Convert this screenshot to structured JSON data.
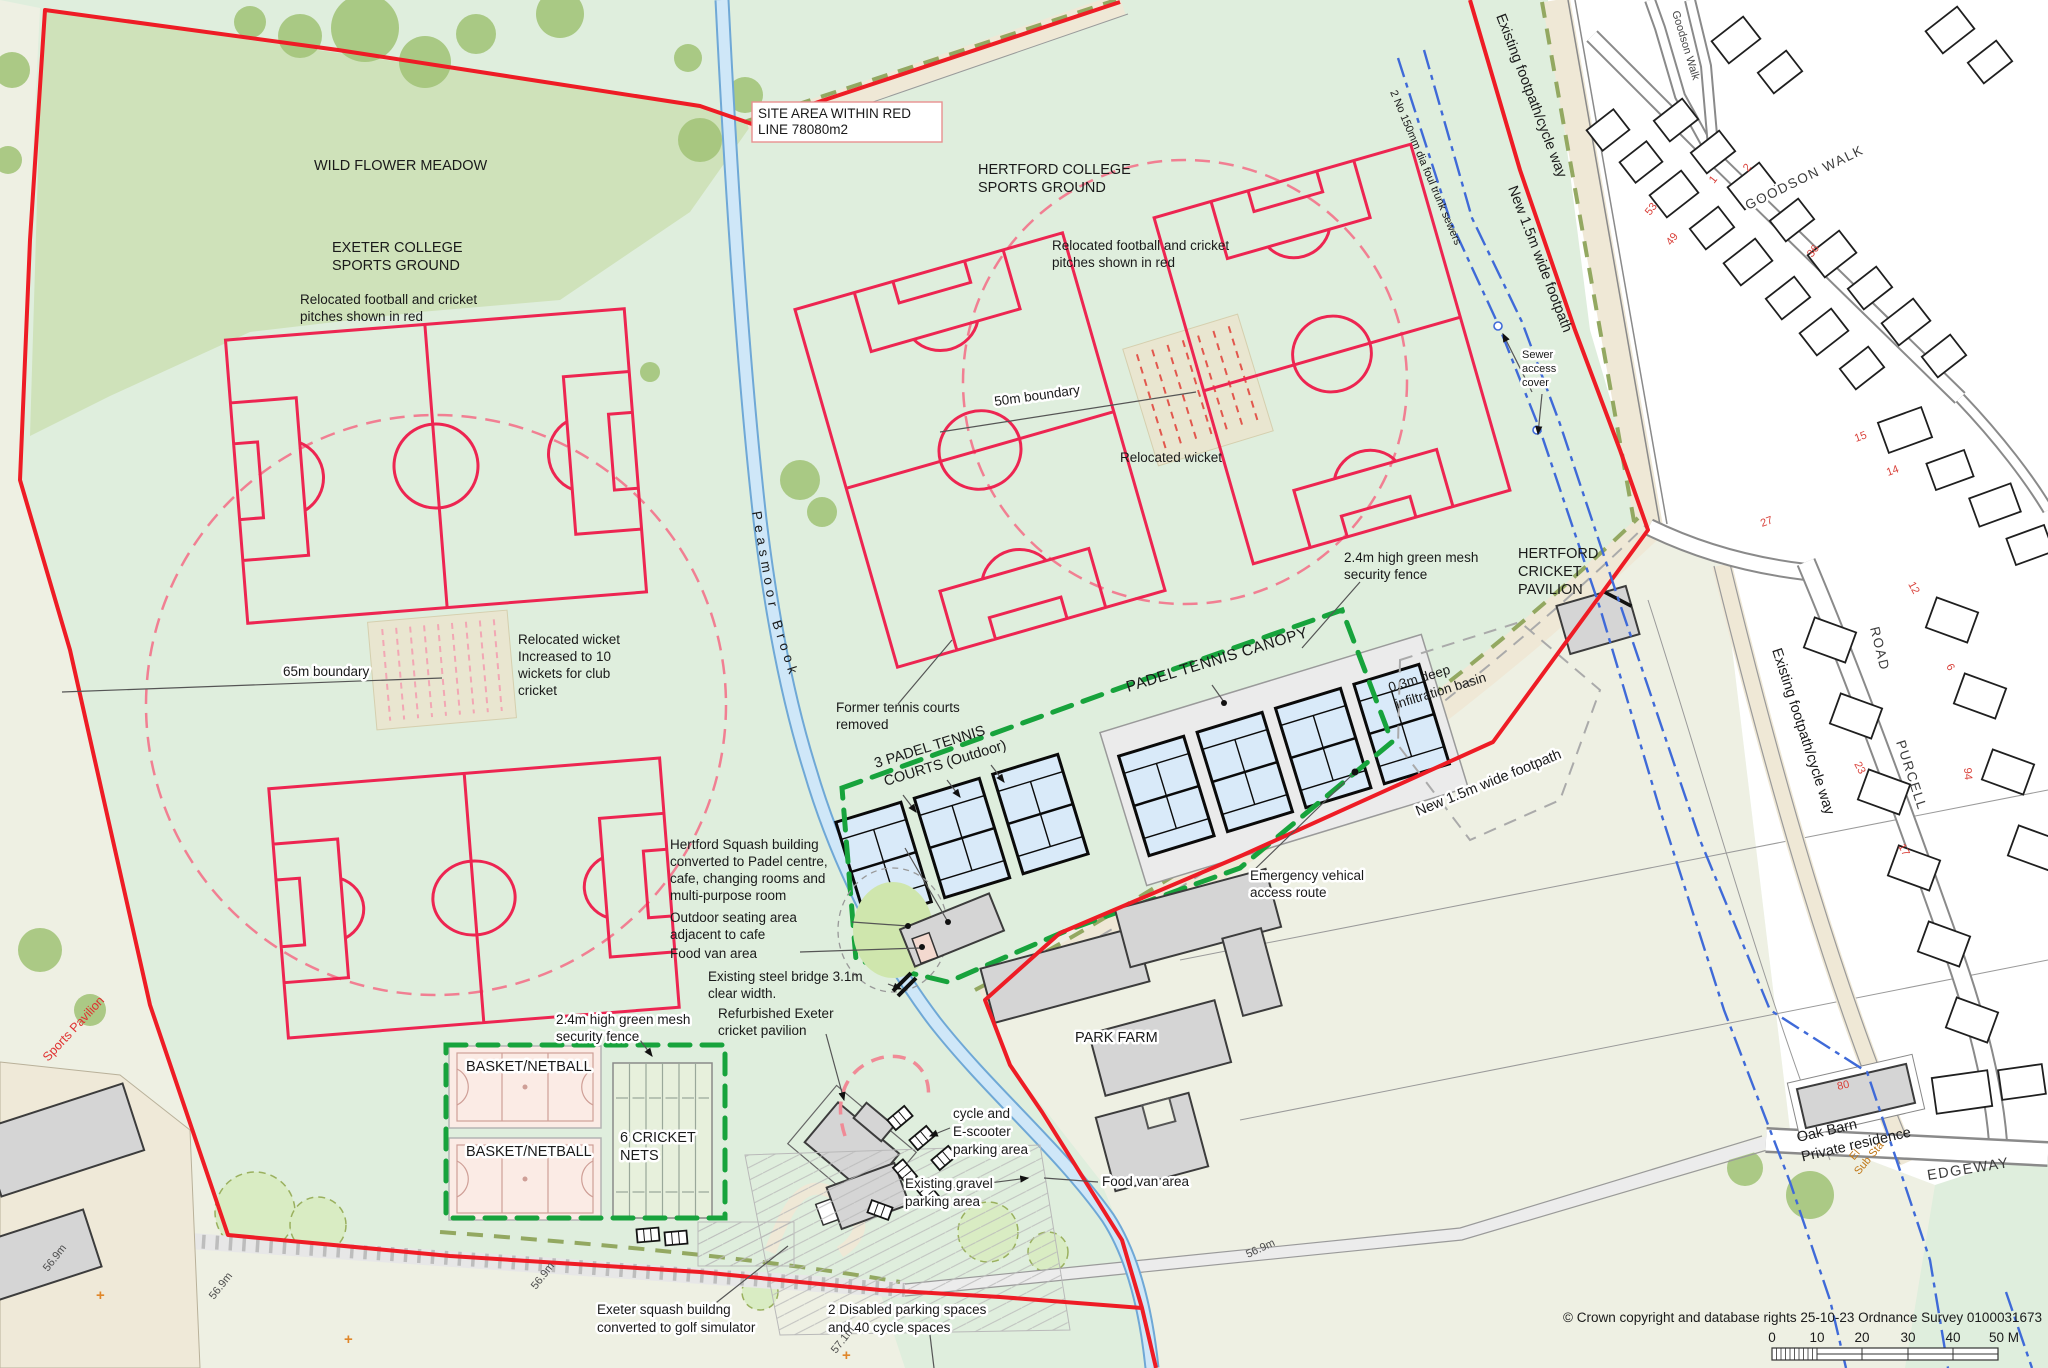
{
  "map": {
    "title_labels": {
      "wild_flower_meadow": "WILD FLOWER MEADOW",
      "exeter_1": "EXETER COLLEGE",
      "exeter_2": "SPORTS GROUND",
      "hertford_1": "HERTFORD COLLEGE",
      "hertford_2": "SPORTS GROUND",
      "park_farm": "PARK FARM",
      "hcp_1": "HERTFORD",
      "hcp_2": "CRICKET",
      "hcp_3": "PAVILION",
      "sports_pavilion": "Sports Pavilion",
      "oak_barn_1": "Oak Barn",
      "oak_barn_2": "Private residence",
      "el_1": "El",
      "el_2": "Sub Sta",
      "brook_1": "Peasmoor",
      "brook_2": "Brook"
    },
    "site_box": {
      "line1": "SITE AREA WITHIN RED",
      "line2": "LINE 78080m2"
    },
    "streets": {
      "goodson_small": "Goodson Walk",
      "goodson_big": "GOODSON WALK",
      "road": "ROAD",
      "purcell": "PURCELL",
      "edgeway": "EDGEWAY"
    },
    "route_labels": {
      "existing_cycle_top": "Existing footpath/cycle way",
      "existing_cycle_right": "Existing footpath/cycle way",
      "new_footpath_top": "New 1.5m wide footpath",
      "new_footpath_mid": "New 1.5m wide footpath",
      "foul_sewers": "2 No 150mm dia foul trunk sewers",
      "sewer_1": "Sewer",
      "sewer_2": "access",
      "sewer_3": "cover"
    },
    "annotations": {
      "relocated_1": "Relocated football and cricket",
      "relocated_2": "pitches shown in red",
      "b50": "50m boundary",
      "b65": "65m boundary",
      "relocated_wicket": "Relocated wicket",
      "wicket_left_1": "Relocated wicket",
      "wicket_left_2": "Increased to 10",
      "wicket_left_3": "wickets for club",
      "wicket_left_4": "cricket",
      "tennis_1": "Former tennis courts",
      "tennis_2": "removed",
      "padel_out_1": "3 PADEL TENNIS",
      "padel_out_2": "COURTS (Outdoor)",
      "padel_canopy": "PADEL TENNIS CANOPY",
      "basin_1": "0.3m deep",
      "basin_2": "infiltration basin",
      "mesh_1": "2.4m high green mesh",
      "mesh_2": "security fence",
      "squash_h_1": "Hertford Squash building",
      "squash_h_2": "converted to Padel centre,",
      "squash_h_3": "cafe, changing rooms and",
      "squash_h_4": "multi-purpose room",
      "seating_1": "Outdoor seating area",
      "seating_2": "adjacent to cafe",
      "food_van": "Food van area",
      "bridge_1": "Existing steel bridge 3.1m",
      "bridge_2": "clear width.",
      "refurb_1": "Refurbished Exeter",
      "refurb_2": "cricket pavilion",
      "emergency_1": "Emergency vehical",
      "emergency_2": "access route",
      "cycle_1": "cycle and",
      "cycle_2": "E-scooter",
      "cycle_3": "parking area",
      "gravel_1": "Existing gravel",
      "gravel_2": "parking area",
      "squash_e_1": "Exeter squash buildng",
      "squash_e_2": "converted to golf simulator",
      "disabled_1": "2 Disabled parking spaces",
      "disabled_2": "and 40 cycle spaces",
      "basket": "BASKET/NETBALL",
      "nets_1": "6 CRICKET",
      "nets_2": "NETS"
    },
    "house_numbers": [
      {
        "t": "53",
        "x": 1650,
        "y": 216,
        "r": -52
      },
      {
        "t": "49",
        "x": 1671,
        "y": 246,
        "r": -52
      },
      {
        "t": "1",
        "x": 1714,
        "y": 184,
        "r": -52
      },
      {
        "t": "2",
        "x": 1748,
        "y": 172,
        "r": -52
      },
      {
        "t": "36",
        "x": 1812,
        "y": 258,
        "r": -52
      },
      {
        "t": "15",
        "x": 1856,
        "y": 442,
        "r": -20
      },
      {
        "t": "14",
        "x": 1888,
        "y": 476,
        "r": -20
      },
      {
        "t": "27",
        "x": 1762,
        "y": 527,
        "r": -20
      },
      {
        "t": "12",
        "x": 1908,
        "y": 584,
        "r": 62
      },
      {
        "t": "6",
        "x": 1946,
        "y": 666,
        "r": 62
      },
      {
        "t": "23",
        "x": 1854,
        "y": 764,
        "r": 62
      },
      {
        "t": "94",
        "x": 1964,
        "y": 768,
        "r": 85
      },
      {
        "t": "17",
        "x": 1898,
        "y": 846,
        "r": 62
      },
      {
        "t": "80",
        "x": 1838,
        "y": 1090,
        "r": -13
      }
    ],
    "spot_heights": [
      {
        "t": "56.9m",
        "x": 48,
        "y": 1272,
        "r": -52
      },
      {
        "t": "56.9m",
        "x": 214,
        "y": 1300,
        "r": -52
      },
      {
        "t": "56.9m",
        "x": 536,
        "y": 1290,
        "r": -52
      },
      {
        "t": "56.9m",
        "x": 1248,
        "y": 1258,
        "r": -25
      },
      {
        "t": "57.1m",
        "x": 836,
        "y": 1354,
        "r": -52
      }
    ],
    "survey_marks": [
      {
        "t": "+",
        "x": 96,
        "y": 1300
      },
      {
        "t": "+",
        "x": 344,
        "y": 1344
      },
      {
        "t": "+",
        "x": 842,
        "y": 1360
      }
    ],
    "footer": {
      "copyright": "© Crown copyright and database rights 25-10-23 Ordnance Survey 0100031673",
      "scale_ticks": [
        "0",
        "10",
        "20",
        "30",
        "40",
        "50 M"
      ]
    },
    "colors": {
      "site_boundary_red": "#ee1c25",
      "pitch_red": "#ed2551",
      "fence_green": "#17a33c",
      "sewer_blue": "#3f6ad8",
      "field_green": "#dfeedd",
      "meadow_green": "#cfe2ba",
      "stream_blue": "#cfe7f8",
      "house_number_red": "#d9413a"
    }
  }
}
